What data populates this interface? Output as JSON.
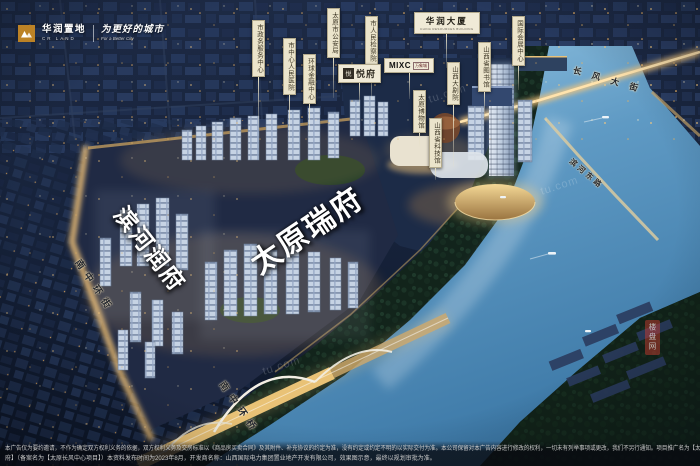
{
  "brand": {
    "name_cn": "华润置地",
    "name_en": "CR LAND",
    "slogan_cn": "为更好的城市",
    "slogan_en": "For a Better City",
    "logo_color": "#bc8226"
  },
  "project_titles": {
    "primary": "太原瑞府",
    "secondary": "滨河润府"
  },
  "landmarks": [
    "市政务服务中心",
    "市中心人民医院",
    "太原市公安局",
    "市人民检察院",
    "环球金融中心",
    "国际会展中心",
    "山西省图书馆",
    "山西大剧院",
    "太原博物馆",
    "山西省科技馆"
  ],
  "signs": {
    "yuefu": {
      "seal": "悦",
      "name": "悦府"
    },
    "mixc": {
      "logo": "MIXC",
      "name": "万象城"
    },
    "cr_tower": {
      "name": "华润大厦",
      "caption": "CHINA RESOURCES BUILDING"
    }
  },
  "roads": [
    "长风大街",
    "滨河东路",
    "南中环街",
    "南中环桥"
  ],
  "watermark": {
    "tile": "tu.com",
    "badge": "楼盘网"
  },
  "disclaimer": {
    "line1": "本广告仅为要约邀请，不作为确定双方权利义务的依据，双方权利义务及交房标准以《商品房买卖合同》及其附件、补充协议的约定为准，没有约定或约定不明的以实际交付为准。本公司保留对本广告内容进行修改的权利，一切未有列举事项或更改，我们不另行通知。项目推广名为【太原瑞府/滨河润",
    "line2": "府】（备案名为【太原长风中心项目】）本资料发布时间为2023年8月，开发商名称：山西国际电力集团置业地产开发有限公司，效果图示意，最终以规划审批为准。"
  },
  "colors": {
    "river": "#5f9ac4",
    "road_glow": "#f0c57e",
    "banner_bg": "#ebe4cb",
    "night_base": "#16223a"
  }
}
